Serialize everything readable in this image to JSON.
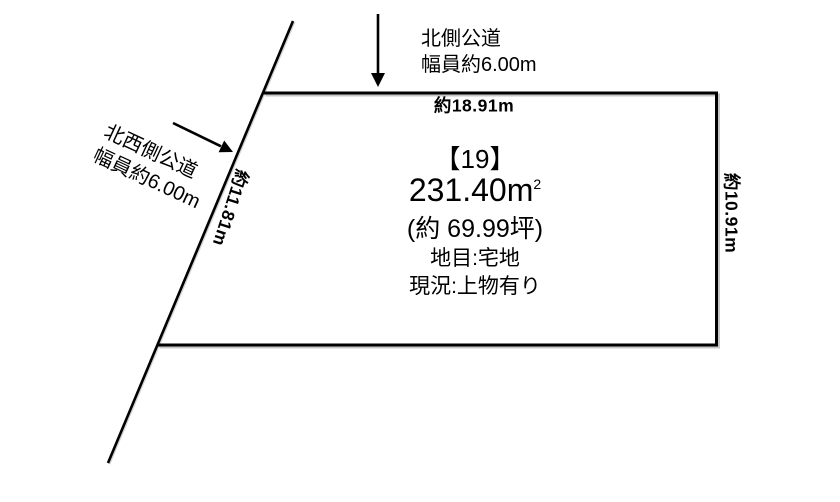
{
  "page": {
    "background": "#ffffff"
  },
  "colors": {
    "line": "#000000",
    "text": "#000000"
  },
  "roads": {
    "north": {
      "name": "北側公道",
      "width": "幅員約6.00m"
    },
    "northwest": {
      "name": "北西側公道",
      "width": "幅員約6.00m"
    }
  },
  "dimensions": {
    "top_edge": "約18.91m",
    "right_edge": "約10.91m",
    "diagonal_edge": "約11.81m"
  },
  "parcel": {
    "number": "【19】",
    "area_main": "231.40m",
    "area_sup": "2",
    "area_tsubo": "(約 69.99坪)",
    "land_category": "地目:宅地",
    "current_status": "現況:上物有り"
  }
}
